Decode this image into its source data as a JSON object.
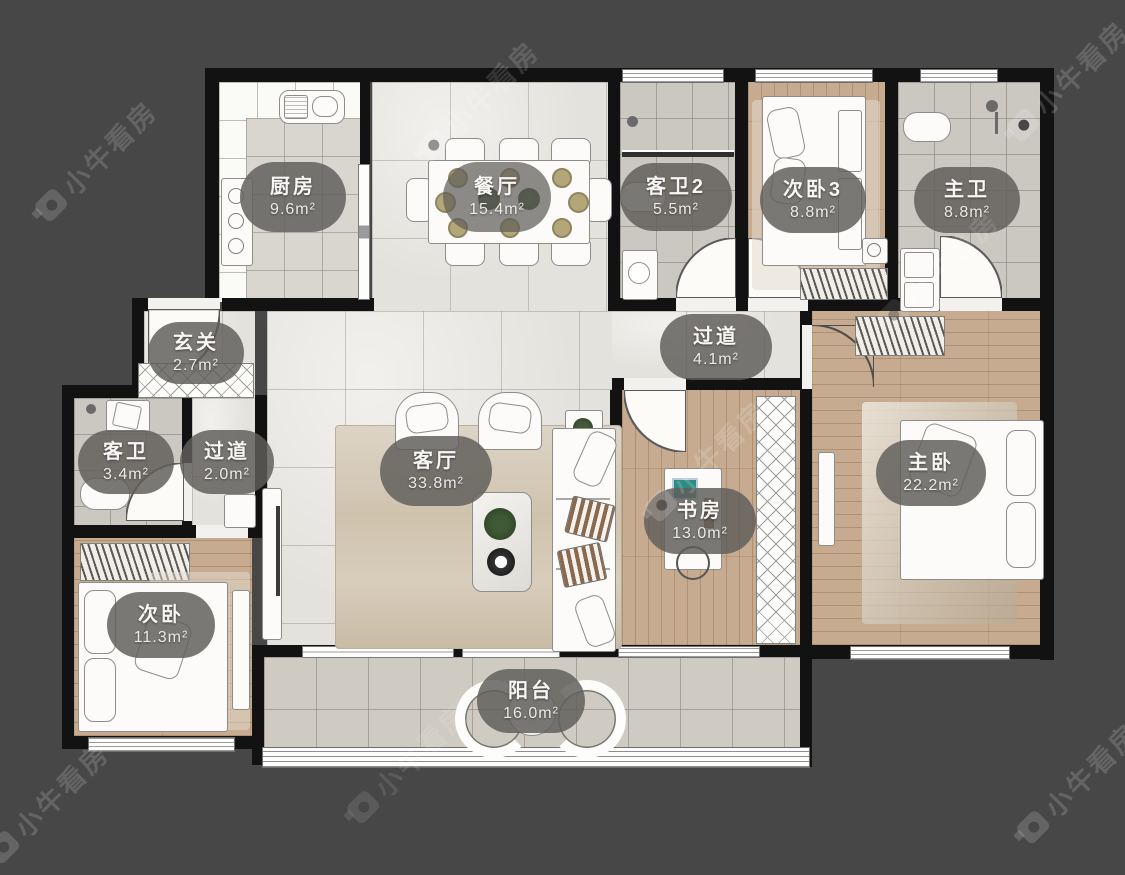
{
  "plan_title": "户型图",
  "watermark": {
    "text": "小牛看房"
  },
  "rooms": [
    {
      "id": "kitchen",
      "name": "厨房",
      "area": "9.6m²"
    },
    {
      "id": "dining",
      "name": "餐厅",
      "area": "15.4m²"
    },
    {
      "id": "guest-bath-2",
      "name": "客卫2",
      "area": "5.5m²"
    },
    {
      "id": "bedroom-3",
      "name": "次卧3",
      "area": "8.8m²"
    },
    {
      "id": "master-bath",
      "name": "主卫",
      "area": "8.8m²"
    },
    {
      "id": "foyer",
      "name": "玄关",
      "area": "2.7m²"
    },
    {
      "id": "corridor",
      "name": "过道",
      "area": "4.1m²"
    },
    {
      "id": "guest-bath",
      "name": "客卫",
      "area": "3.4m²"
    },
    {
      "id": "corridor-2",
      "name": "过道",
      "area": "2.0m²"
    },
    {
      "id": "living",
      "name": "客厅",
      "area": "33.8m²"
    },
    {
      "id": "study",
      "name": "书房",
      "area": "13.0m²"
    },
    {
      "id": "master-bedroom",
      "name": "主卧",
      "area": "22.2m²"
    },
    {
      "id": "bedroom-2",
      "name": "次卧",
      "area": "11.3m²"
    },
    {
      "id": "balcony",
      "name": "阳台",
      "area": "16.0m²"
    }
  ]
}
